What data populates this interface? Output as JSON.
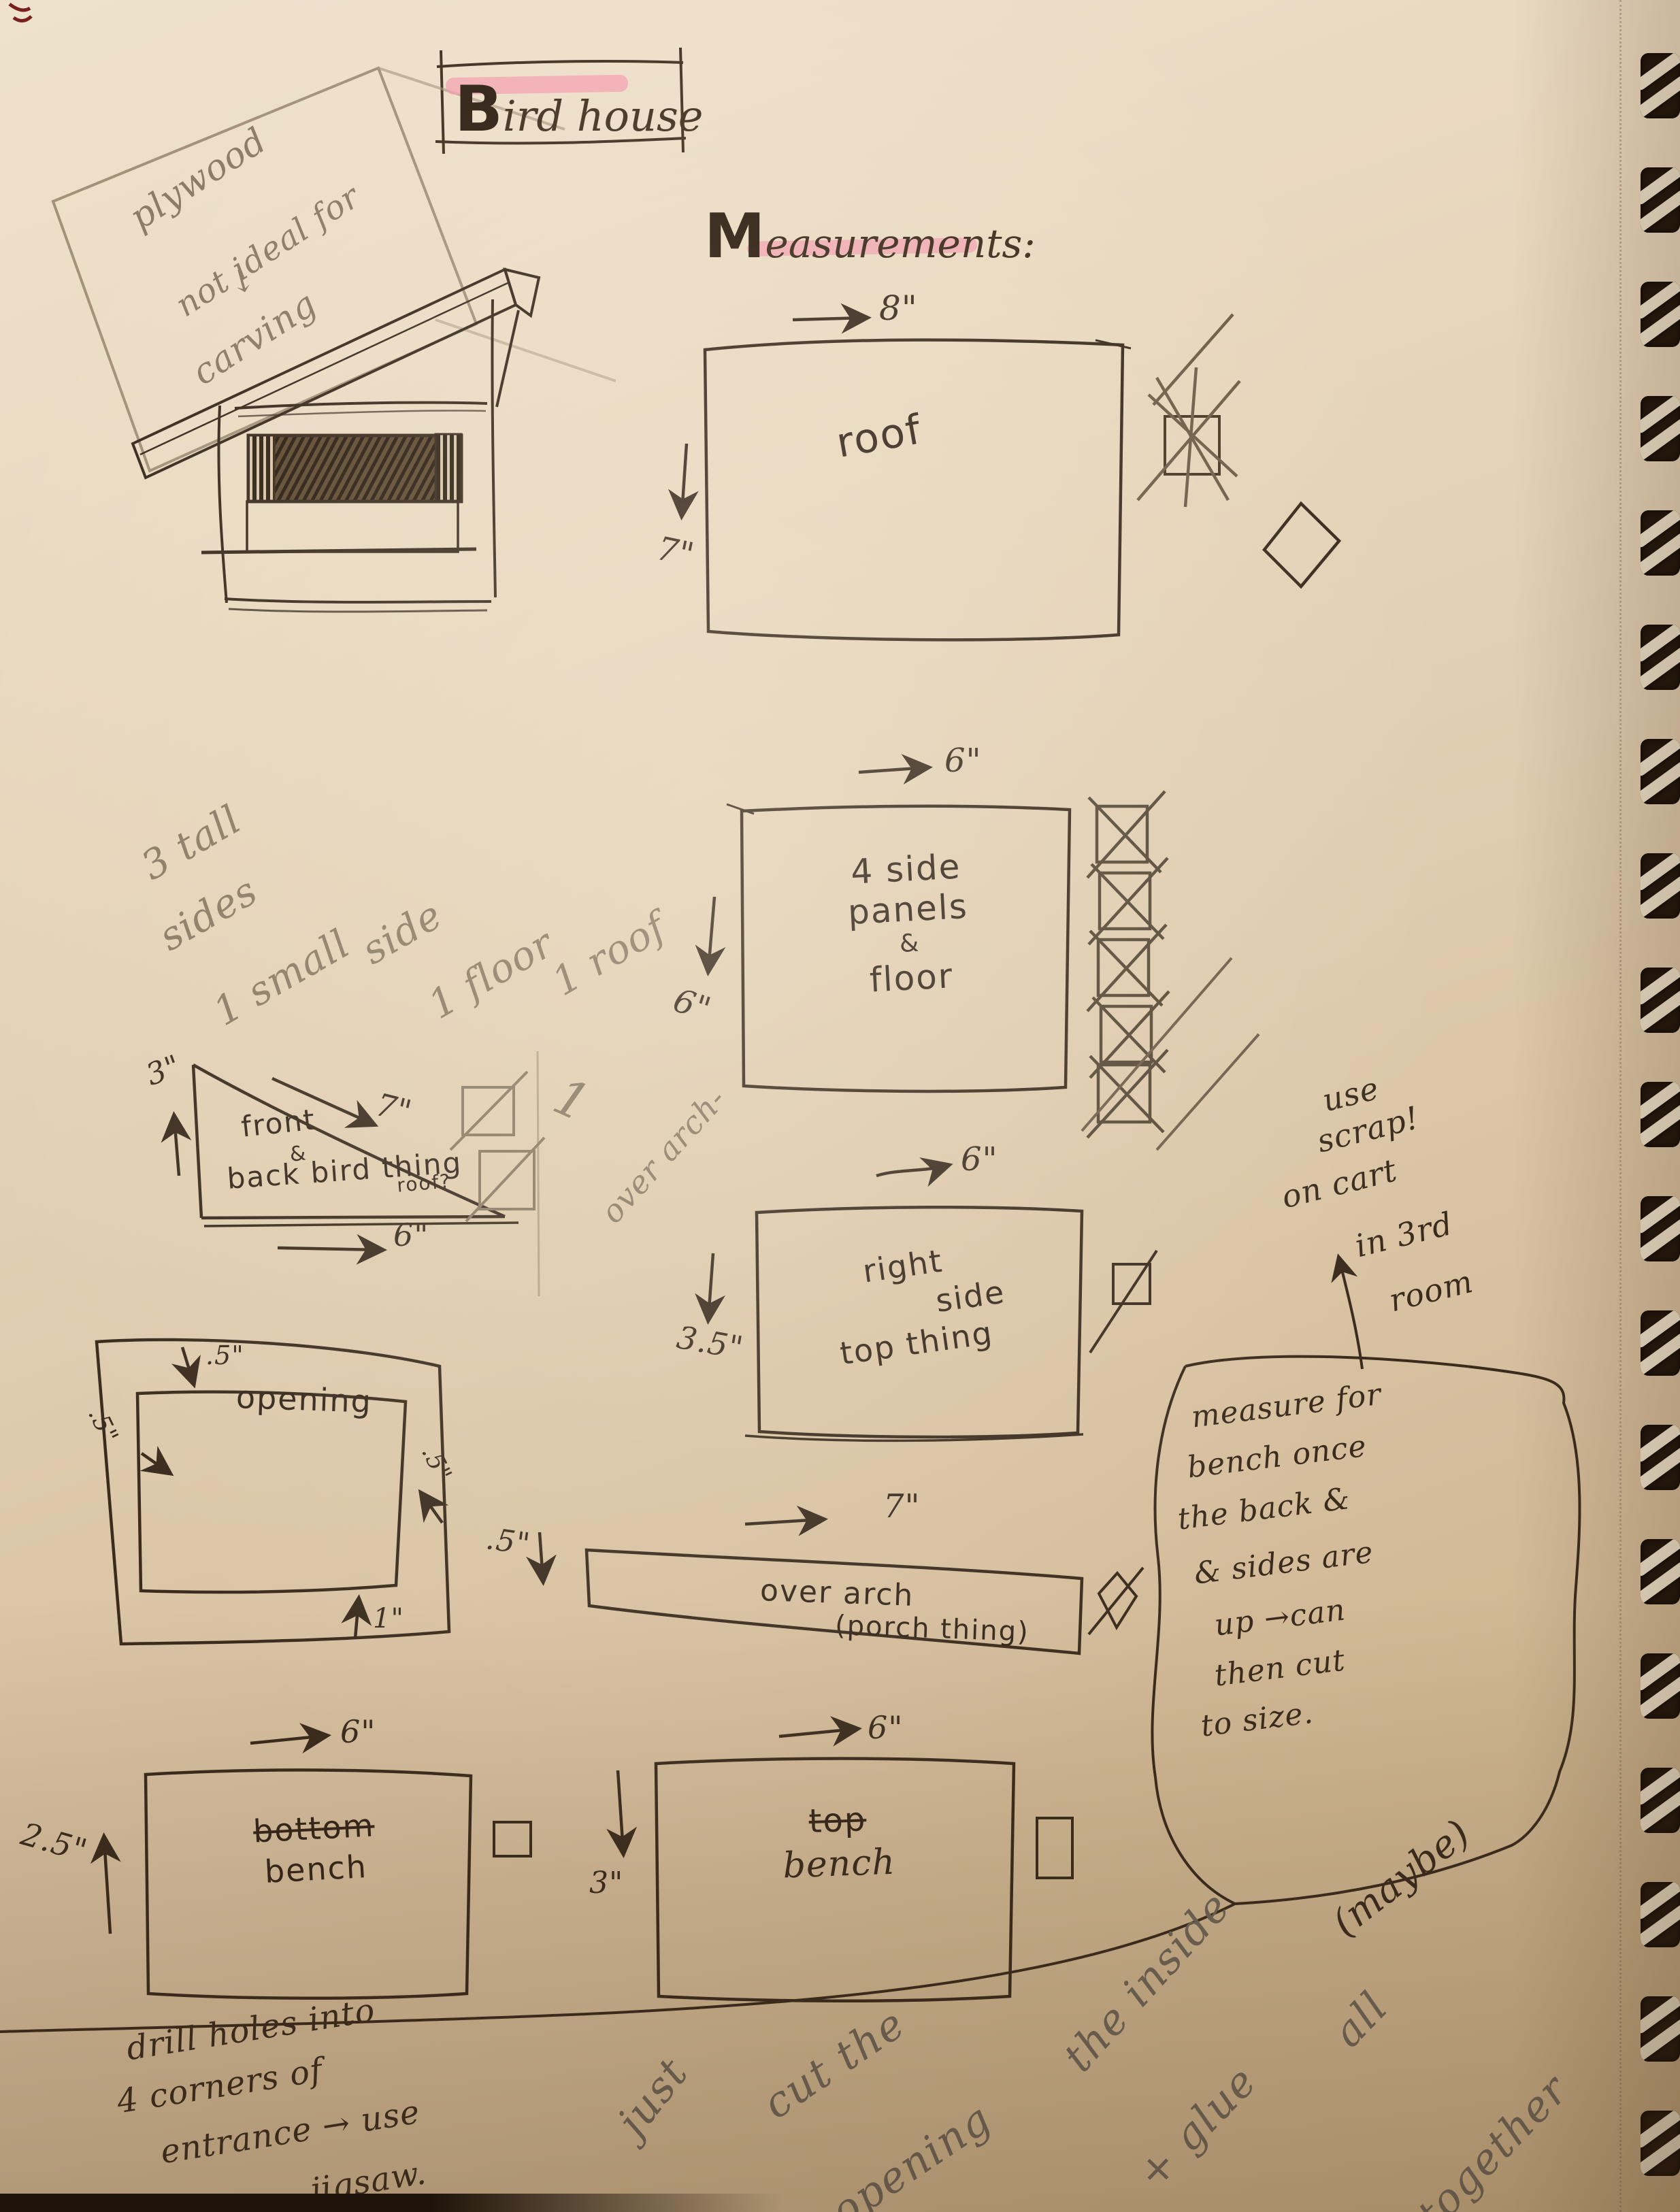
{
  "header": {
    "title": "Bird house",
    "measurements_heading": "Measurements:"
  },
  "glyphs": {
    "right_arrow": "→",
    "down_arrow": "↓",
    "up_arrow": "↑"
  },
  "pencil_notes": {
    "plywood_line1": "plywood",
    "plywood_arrow": "↓",
    "plywood_line2": "not ideal for",
    "plywood_line3": "carving",
    "tally": [
      "3 tall",
      "sides",
      "1 small",
      "side",
      "1 floor",
      "1 roof"
    ],
    "tally_over_arch_count": "1",
    "tally_over_arch": "over arch-",
    "assembly": [
      "just",
      "cut the",
      "opening",
      "the inside",
      "(maybe)",
      "+ glue",
      "all",
      "together"
    ]
  },
  "ink_notes": {
    "use_scrap": [
      "use",
      "scrap!",
      "on cart",
      "in 3rd",
      "room"
    ],
    "bench_note": [
      "measure for",
      "bench once",
      "the back &",
      "& sides are",
      "up →can",
      "then cut",
      "to size."
    ],
    "drill_note": [
      "drill holes into",
      "4 corners of",
      "entrance → use",
      "jigsaw."
    ]
  },
  "pieces": {
    "roof": {
      "name": "roof",
      "width": "8\"",
      "height": "7\""
    },
    "side_panels": {
      "line1": "4 side",
      "line2": "panels",
      "line3": "&",
      "line4": "floor",
      "width": "6\"",
      "height": "6\""
    },
    "right_side": {
      "line1": "right",
      "line2": "side",
      "line3": "top thing",
      "width": "6\"",
      "height": "3.5\""
    },
    "over_arch": {
      "line1": "over arch",
      "line2": "(porch thing)",
      "width": "7\"",
      "height": ".5\""
    },
    "bottom_bench": {
      "line1": "bottom",
      "line2": "bench",
      "width": "6\"",
      "height": "2.5\""
    },
    "top_bench": {
      "line1": "top",
      "line2": "bench",
      "width": "6\"",
      "height": "3\""
    },
    "gable": {
      "line1": "front",
      "line2": "&",
      "line3": "back bird thing",
      "line4": "roof?",
      "height": "3\"",
      "hypotenuse": "7\"",
      "width": "6\""
    },
    "opening": {
      "name": "opening",
      "top": ".5\"",
      "left": ".5\"",
      "right": ".5\"",
      "bottom": "1\""
    }
  }
}
